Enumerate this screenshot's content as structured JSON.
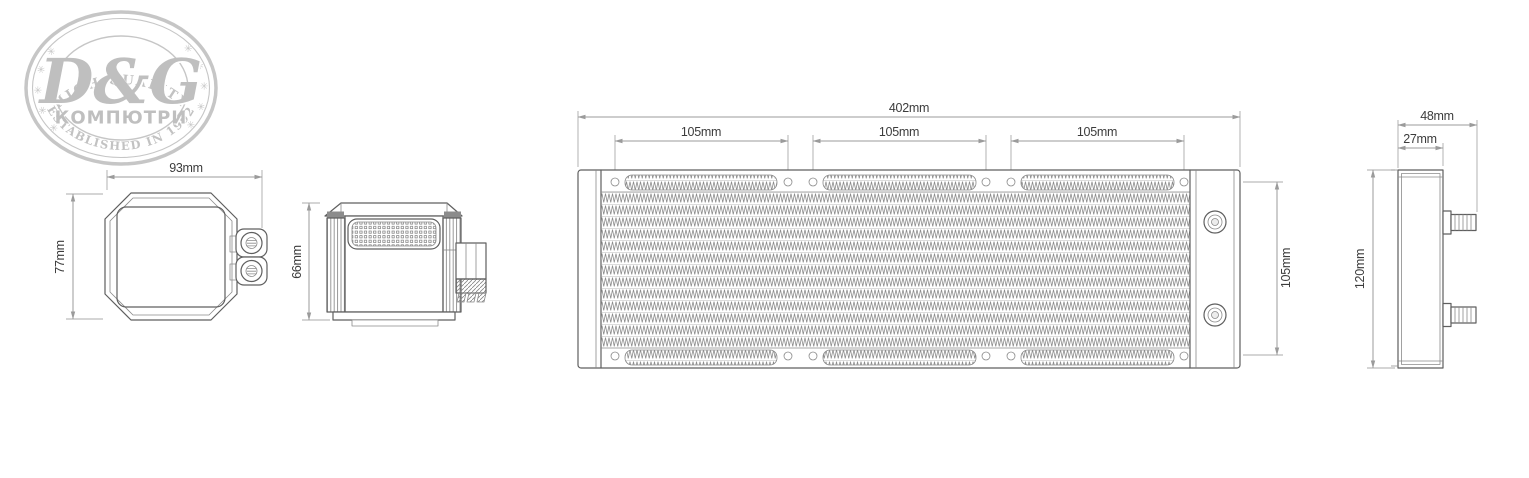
{
  "logo": {
    "arc_top": "HIGH QUALITY",
    "brand": "D&G",
    "brand_sub": "КОМПЮТРИ",
    "arc_bottom": "ESTABLISHED IN 1992",
    "stars_left": "✳ ✳ ✳ ✳ ✳ ✳ ✳",
    "stars_right": "✳ ✳ ✳ ✳ ✳ ✳ ✳"
  },
  "dimensions": {
    "pump_front": {
      "width": "93mm",
      "height": "77mm"
    },
    "pump_side": {
      "height": "66mm"
    },
    "radiator_top": {
      "total_length": "402mm",
      "fan_spacing": [
        "105mm",
        "105mm",
        "105mm"
      ],
      "width": "105mm"
    },
    "radiator_side": {
      "depth_total": "48mm",
      "depth_core": "27mm",
      "height": "120mm"
    }
  },
  "colors": {
    "background": "#ffffff",
    "drawing_line": "#5f5f5f",
    "dimension_line": "#9b9b9b",
    "dimension_text": "#3c3c3c",
    "logo_gray": "#c3c3c3"
  }
}
